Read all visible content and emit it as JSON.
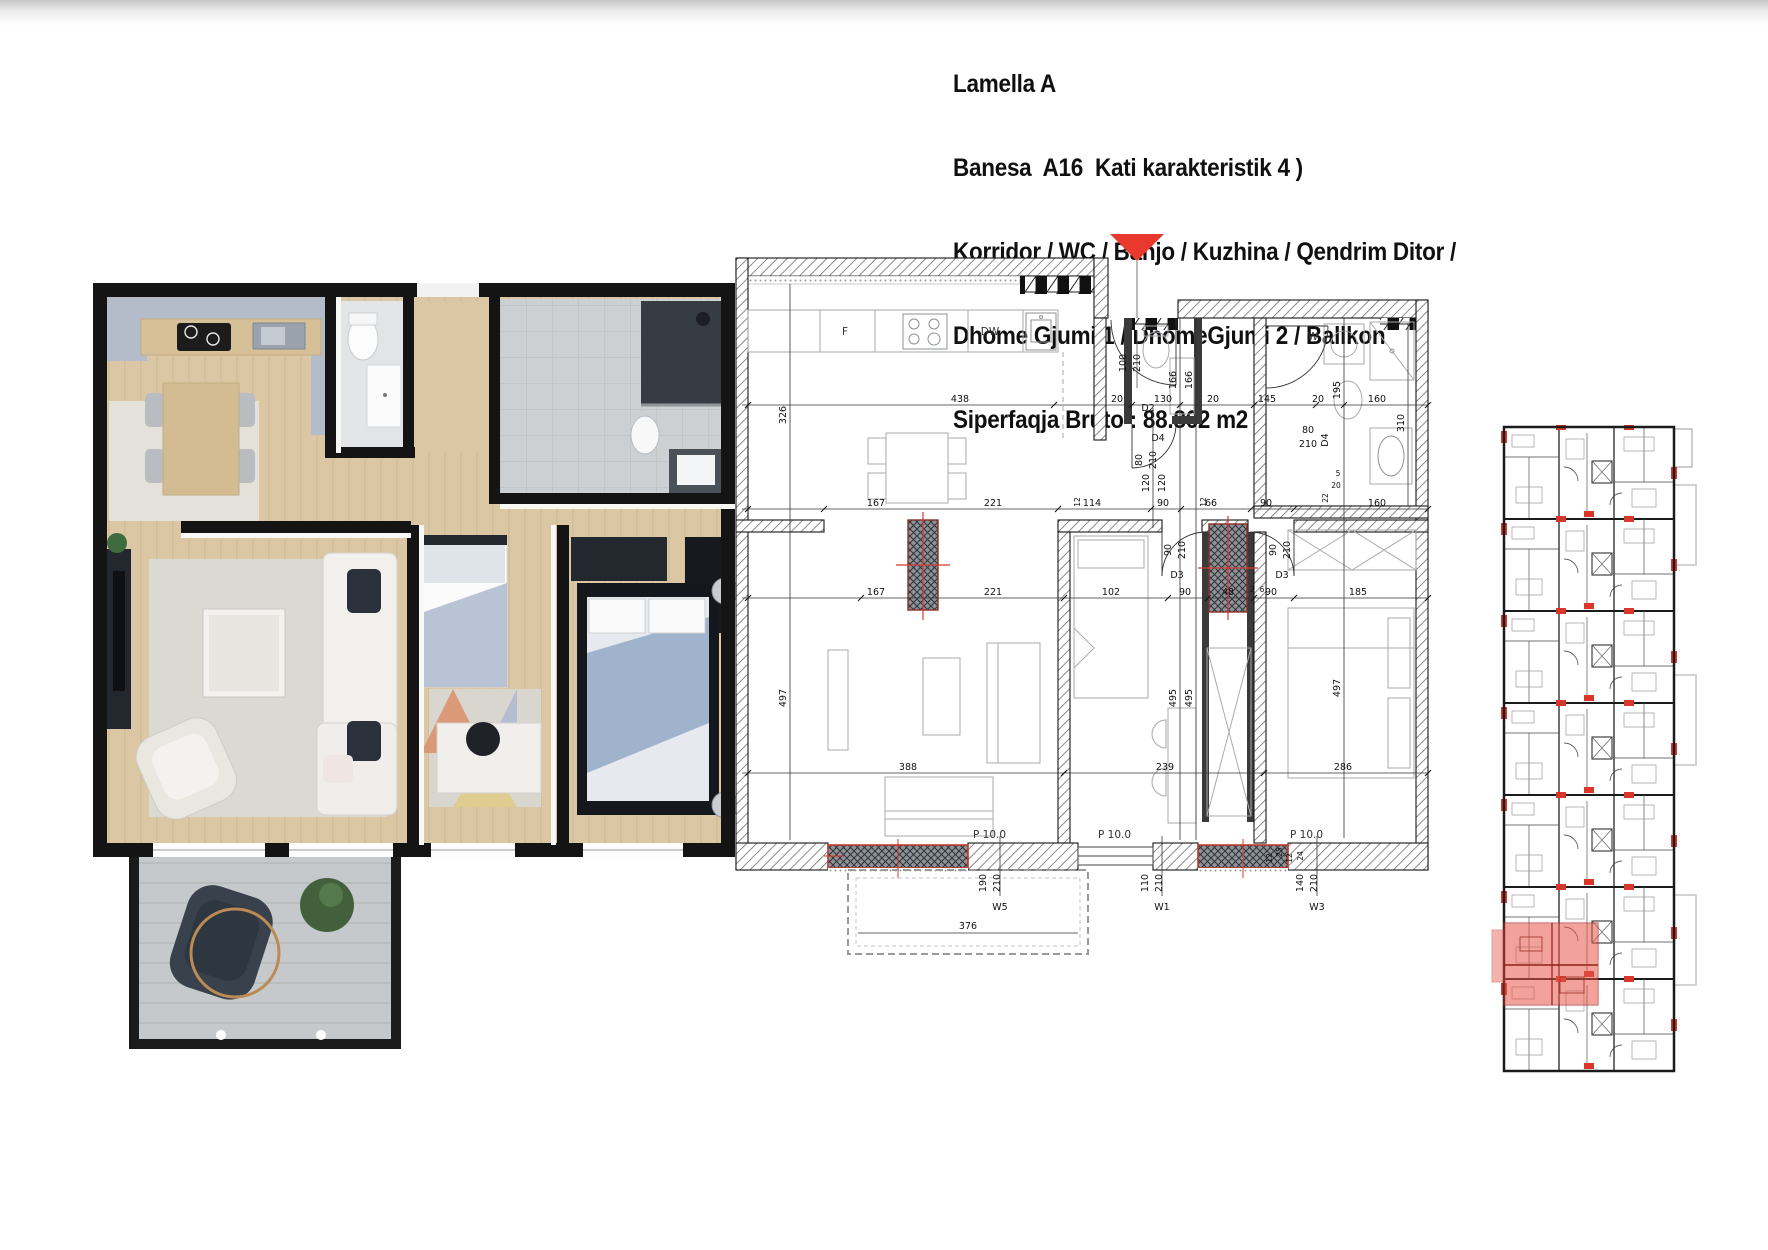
{
  "header": {
    "line1": "Lamella A",
    "line2": "Banesa  A16  Kati karakteristik 4 )",
    "line3": "Korridor / WC / Banjo / Kuzhina / Qendrim Ditor /",
    "line4": "Dhome Gjumi 1 / DhomeGjumi 2 / Ballkon",
    "line5": "Siperfaqja Bruto : 88.862 m2"
  },
  "colors": {
    "entry_marker": "#e8392e",
    "highlight_unit": "#e8564a",
    "wall_black": "#141414",
    "wood_floor": "#dbc7a3",
    "accent_blue_gray": "#b3bcc8"
  },
  "tech": {
    "r1": [
      "438",
      "20",
      "130",
      "20",
      "145",
      "20",
      "160"
    ],
    "r2": [
      "167",
      "221",
      "114",
      "90",
      "66",
      "90",
      "160"
    ],
    "r3": [
      "167",
      "221",
      "102",
      "90",
      "48",
      "90",
      "185"
    ],
    "r4": [
      "388",
      "239",
      "286"
    ],
    "balcony_width": "376",
    "v": {
      "kitchen": "326",
      "living": "497",
      "bed2": "497",
      "bed1a": "495",
      "bed1b": "495",
      "wc1": "166",
      "wc2": "166",
      "bath1": "195",
      "bath2": "310",
      "hall1": "120",
      "hall2": "120"
    },
    "doors": {
      "d2": "D2",
      "d3": "D3",
      "d4": "D4",
      "w100": "100",
      "w90": "90",
      "w80": "80",
      "h210": "210"
    },
    "appliances": {
      "fridge": "F",
      "dishwasher": "DW",
      "washer": "W"
    },
    "area": "P 10.0",
    "win": {
      "w5": "W5",
      "w1": "W1",
      "w3": "W3",
      "w5w": "190",
      "w1w": "110",
      "w3w": "140",
      "h": "210"
    },
    "small": {
      "s12": "12",
      "s25": "25",
      "s24": "24",
      "s5": "5",
      "s20": "20",
      "s22": "22",
      "s2": "2",
      "s6": "6"
    }
  }
}
